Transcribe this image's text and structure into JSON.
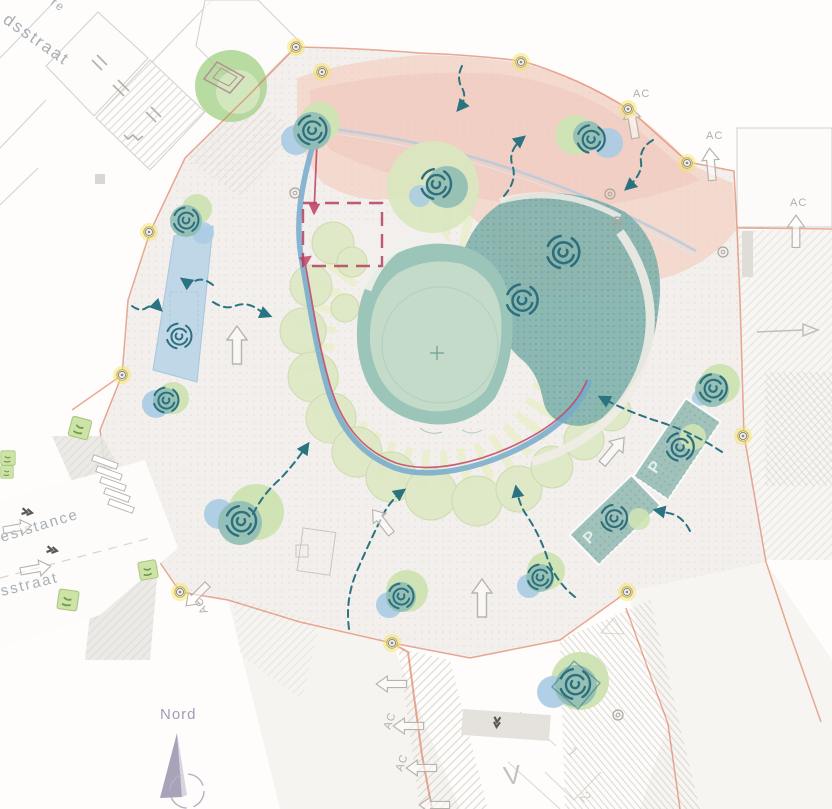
{
  "labels": {
    "street_top": "dsstraat",
    "street_top_fragment": "re",
    "street_left_upper": "esistance",
    "street_left_lower": "sstraat",
    "compass_north": "Nord",
    "access": "AC",
    "parking": "P",
    "road_marking_v": "V",
    "house_number_1": "1",
    "house_number_2": "2"
  },
  "colors": {
    "plaza_boundary_orange": "#dd7352",
    "pink_zone": "#f3c9ba",
    "stream_blue": "#74aace",
    "canal_blue": "#b9d4e7",
    "pond_teal": "#9cc5b9",
    "pond_inner_green": "#c6dcca",
    "canopy_dark_teal": "#7db0ab",
    "tree_light_green": "#dde8c4",
    "tree_bright_green": "#a6d28c",
    "spiral_symbol_teal": "#2d6f7d",
    "flow_arrow_teal": "#2a7380",
    "route_crimson": "#c2476a",
    "node_highlight_yellow": "#f4e565",
    "sunburst_green": "#e9efc9",
    "linework_gray": "#c6c2bc",
    "label_gray": "#b3afa9",
    "street_label_gray": "#98a1ab",
    "compass_purple": "#9a93ad"
  },
  "icons": {
    "tree": "spiral-tree-icon",
    "flow": "flow-arrow-icon",
    "pedestrian": "outline-arrow-icon",
    "boundary_tree": "yellow-node-marker-icon",
    "compass": "north-needle-icon",
    "bush": "bush-planter-icon"
  }
}
